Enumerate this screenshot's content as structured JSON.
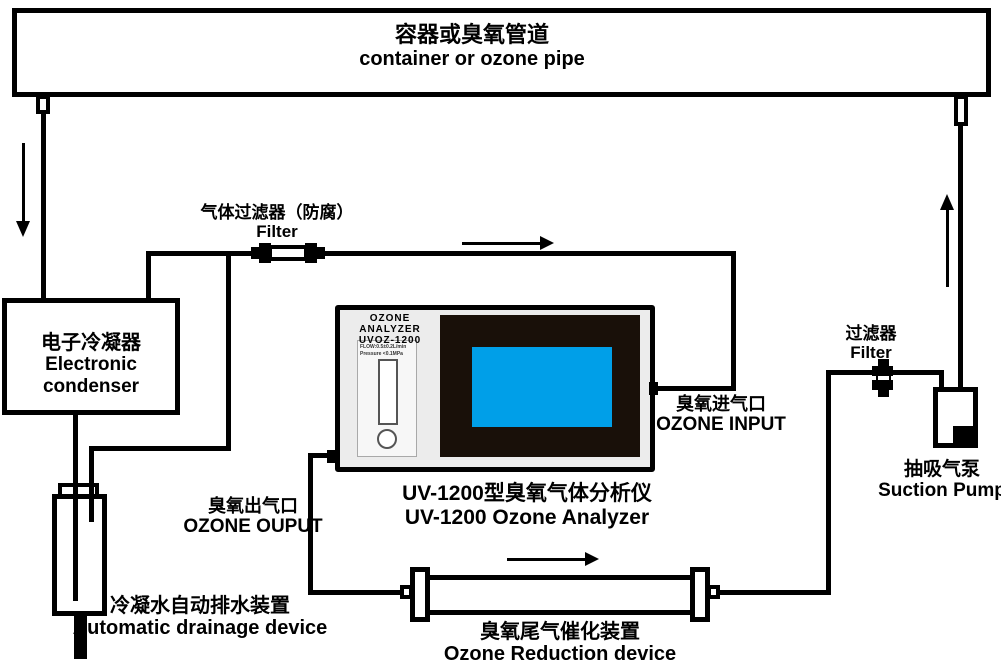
{
  "labels": {
    "container_zh": "容器或臭氧管道",
    "container_en": "container or ozone pipe",
    "condenser_zh": "电子冷凝器",
    "condenser_en": "Electronic condenser",
    "gas_filter_zh": "气体过滤器（防腐）",
    "gas_filter_en": "Filter",
    "ozone_input_zh": "臭氧进气口",
    "ozone_input_en": "OZONE INPUT",
    "ozone_output_zh": "臭氧出气口",
    "ozone_output_en": "OZONE OUPUT",
    "analyzer_zh": "UV-1200型臭氧气体分析仪",
    "analyzer_en": "UV-1200 Ozone Analyzer",
    "drainage_zh": "冷凝水自动排水装置",
    "drainage_en": "Automatic drainage device",
    "reduction_zh": "臭氧尾气催化装置",
    "reduction_en": "Ozone Reduction device",
    "right_filter_zh": "过滤器",
    "right_filter_en": "Filter",
    "pump_zh": "抽吸气泵",
    "pump_en": "Suction Pump"
  },
  "analyzer_device": {
    "brand": "OZONE ANALYZER",
    "model": "UVOZ-1200",
    "flow_spec_line1": "FLOW:0.5±0.2L/min",
    "flow_spec_line2": "Pressure <0.1MPa"
  },
  "colors": {
    "line": "#000000",
    "analyzer_body": "#ececec",
    "screen_bezel": "#191009",
    "screen_fill": "#009fe8"
  }
}
